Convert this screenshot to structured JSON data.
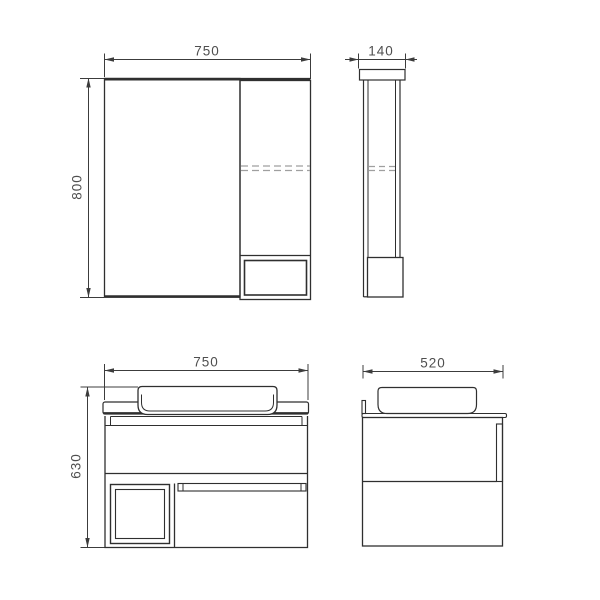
{
  "drawing": {
    "type": "furniture-technical-drawing",
    "background_color": "#ffffff",
    "line_color": "#2f2f2f",
    "dimension_line_color": "#3c3c3c",
    "dashed_line_color": "#9f9f9f",
    "dimension_text_color": "#4f4f4f",
    "views": {
      "mirror_cabinet_front": {
        "width_mm": "750",
        "height_mm": "800"
      },
      "mirror_cabinet_side": {
        "depth_mm": "140"
      },
      "vanity_front": {
        "width_mm": "750",
        "height_mm": "630"
      },
      "vanity_side": {
        "depth_mm": "520"
      }
    }
  }
}
